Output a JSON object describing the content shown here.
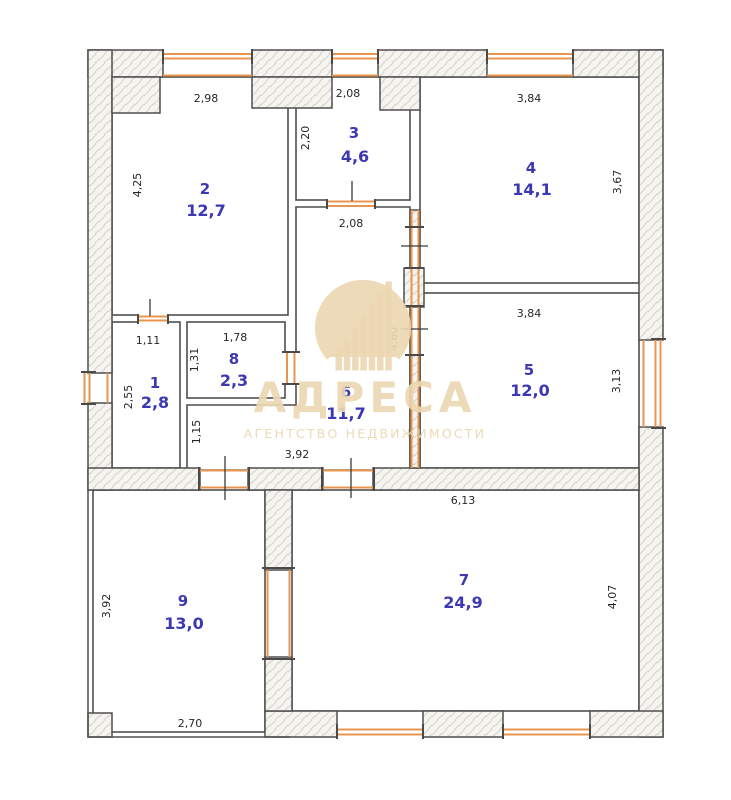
{
  "watermark": {
    "brand": "АДРЕСА",
    "tagline": "АГЕНТСТВО НЕДВИЖИМОСТИ"
  },
  "colors": {
    "wall_outline": "#4f4f4f",
    "window_door_accent": "#e8954f",
    "room_label": "#3c38b3",
    "dimension_text": "#272727",
    "watermark": "#ecd7b2",
    "wall_hatch_fill": "#f6f4f0"
  },
  "rooms": [
    {
      "number": "1",
      "area": "2,8"
    },
    {
      "number": "2",
      "area": "12,7"
    },
    {
      "number": "3",
      "area": "4,6"
    },
    {
      "number": "4",
      "area": "14,1"
    },
    {
      "number": "5",
      "area": "12,0"
    },
    {
      "number": "6",
      "area": "11,7"
    },
    {
      "number": "7",
      "area": "24,9"
    },
    {
      "number": "8",
      "area": "2,3"
    },
    {
      "number": "9",
      "area": "13,0"
    }
  ],
  "dimensions": [
    {
      "value": "2,98",
      "edge": "room-2-top"
    },
    {
      "value": "4,25",
      "edge": "room-2-left"
    },
    {
      "value": "2,08",
      "edge": "room-3-top"
    },
    {
      "value": "2,20",
      "edge": "room-3-left"
    },
    {
      "value": "3,84",
      "edge": "room-4-top"
    },
    {
      "value": "3,67",
      "edge": "room-4-right"
    },
    {
      "value": "2,08",
      "edge": "room-3-bottom"
    },
    {
      "value": "1,11",
      "edge": "room-1-top"
    },
    {
      "value": "2,55",
      "edge": "room-1-left"
    },
    {
      "value": "1,78",
      "edge": "room-8-top"
    },
    {
      "value": "1,31",
      "edge": "room-8-left"
    },
    {
      "value": "1,15",
      "edge": "room-6-strip-left"
    },
    {
      "value": "3,92",
      "edge": "room-6-bottom"
    },
    {
      "value": "4,60",
      "edge": "room-6-right"
    },
    {
      "value": "3,84",
      "edge": "room-5-top"
    },
    {
      "value": "3,13",
      "edge": "room-5-right"
    },
    {
      "value": "6,13",
      "edge": "room-7-top"
    },
    {
      "value": "4,07",
      "edge": "room-7-right"
    },
    {
      "value": "3,92",
      "edge": "room-9-left"
    },
    {
      "value": "2,70",
      "edge": "room-9-bottom"
    }
  ]
}
